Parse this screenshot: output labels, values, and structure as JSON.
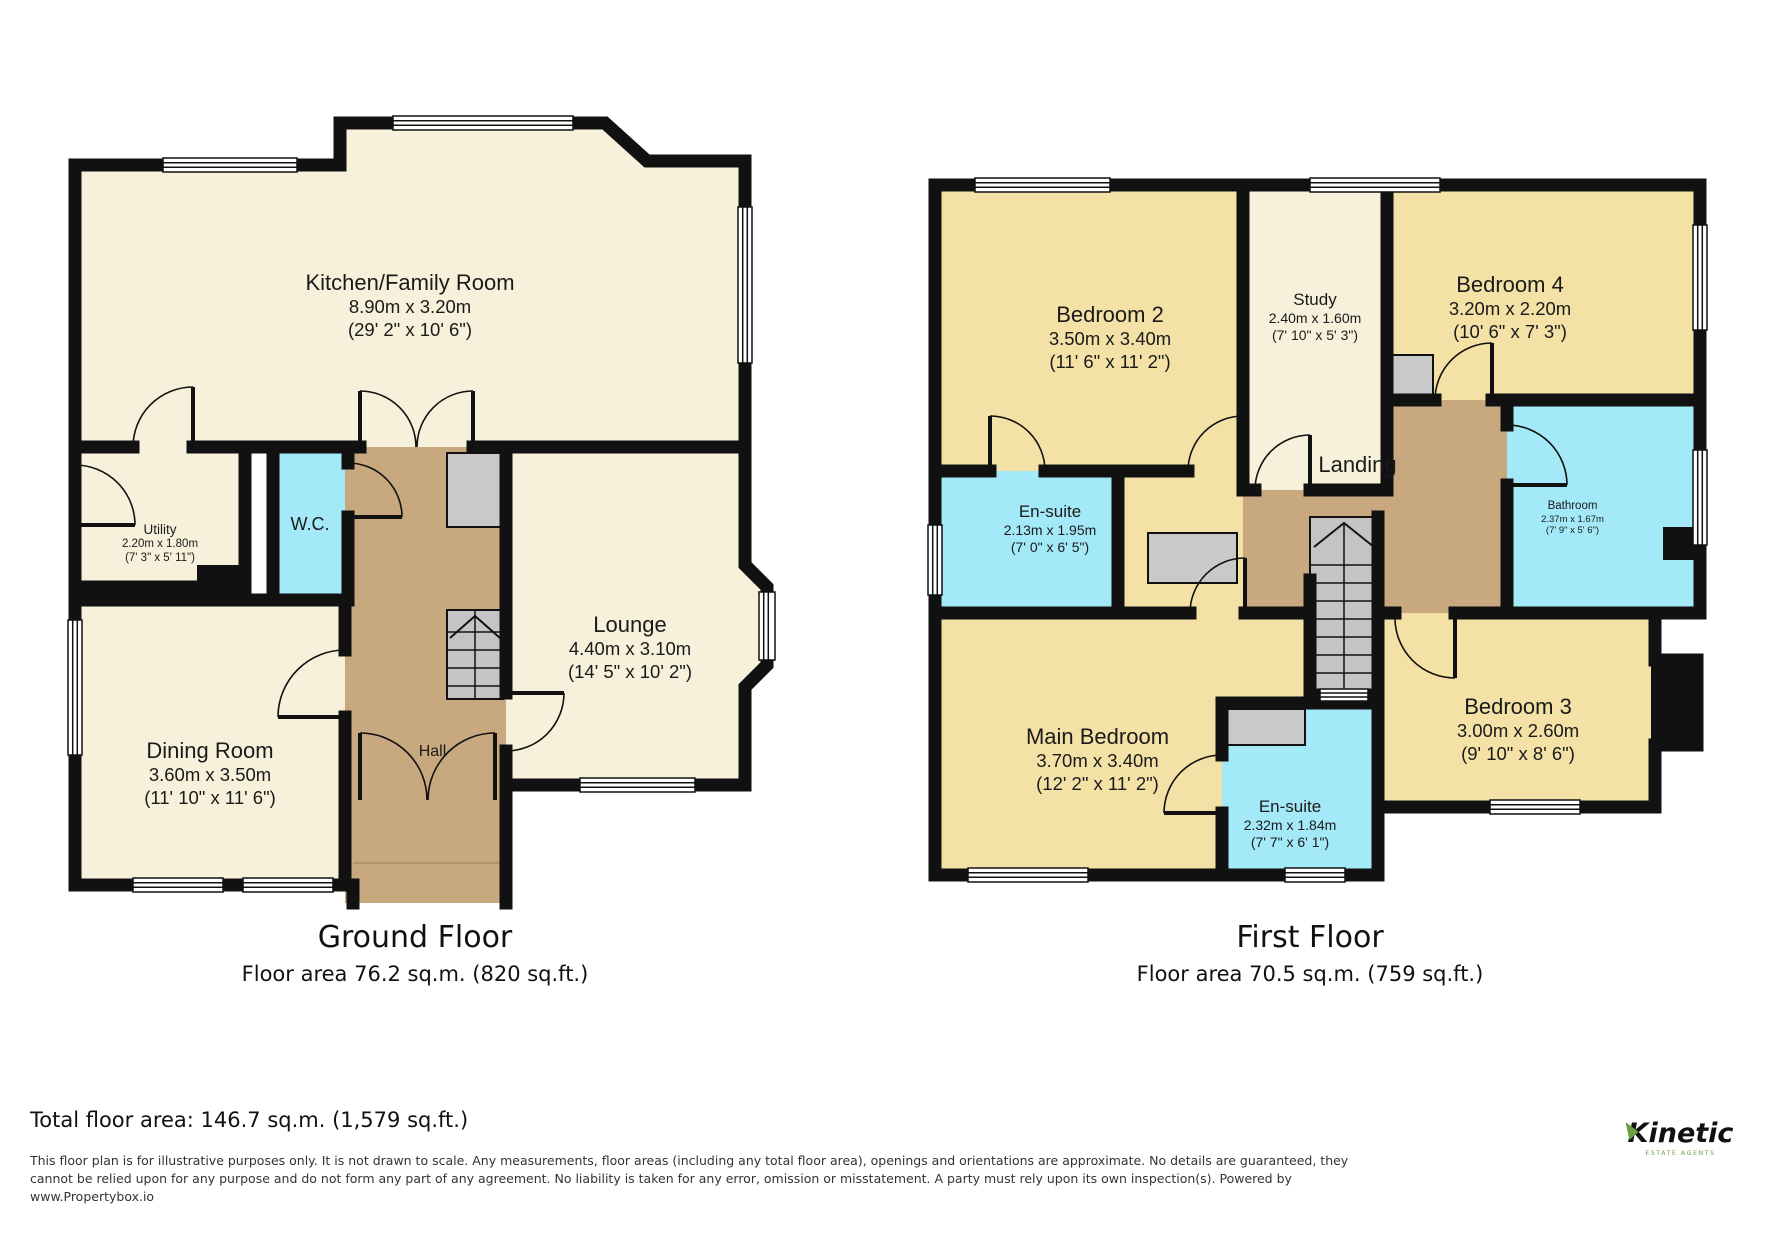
{
  "colors": {
    "room_cream": "#F7F1DB",
    "room_tan": "#F3E1A6",
    "room_cyan": "#A3E9F7",
    "hall_brown": "#C8A87E",
    "stair_gray": "#C4C4C4",
    "wall": "#111111",
    "logo_green": "#69A041"
  },
  "ground_floor": {
    "caption": "Ground Floor",
    "area_caption": "Floor area 76.2 sq.m. (820 sq.ft.)",
    "rooms": [
      {
        "id": "kitchen",
        "name": "Kitchen/Family Room",
        "metric": "8.90m x 3.20m",
        "imperial": "(29' 2\" x 10' 6\")"
      },
      {
        "id": "utility",
        "name": "Utility",
        "metric": "2.20m x 1.80m",
        "imperial": "(7' 3\" x 5' 11\")"
      },
      {
        "id": "wc",
        "name": "W.C."
      },
      {
        "id": "dining",
        "name": "Dining Room",
        "metric": "3.60m x 3.50m",
        "imperial": "(11' 10\" x 11' 6\")"
      },
      {
        "id": "hall",
        "name": "Hall"
      },
      {
        "id": "lounge",
        "name": "Lounge",
        "metric": "4.40m x 3.10m",
        "imperial": "(14' 5\" x 10' 2\")"
      }
    ]
  },
  "first_floor": {
    "caption": "First Floor",
    "area_caption": "Floor area 70.5 sq.m. (759 sq.ft.)",
    "rooms": [
      {
        "id": "bedroom2",
        "name": "Bedroom 2",
        "metric": "3.50m x 3.40m",
        "imperial": "(11' 6\" x 11' 2\")"
      },
      {
        "id": "study",
        "name": "Study",
        "metric": "2.40m x 1.60m",
        "imperial": "(7' 10\" x 5' 3\")"
      },
      {
        "id": "bedroom4",
        "name": "Bedroom 4",
        "metric": "3.20m x 2.20m",
        "imperial": "(10' 6\" x 7' 3\")"
      },
      {
        "id": "ensuite1",
        "name": "En-suite",
        "metric": "2.13m x 1.95m",
        "imperial": "(7' 0\" x 6' 5\")"
      },
      {
        "id": "landing",
        "name": "Landing"
      },
      {
        "id": "bathroom",
        "name": "Bathroom",
        "metric": "2.37m x 1.67m",
        "imperial": "(7' 9\" x 5' 6\")"
      },
      {
        "id": "main_bedroom",
        "name": "Main Bedroom",
        "metric": "3.70m x 3.40m",
        "imperial": "(12' 2\" x 11' 2\")"
      },
      {
        "id": "ensuite2",
        "name": "En-suite",
        "metric": "2.32m x 1.84m",
        "imperial": "(7' 7\" x 6' 1\")"
      },
      {
        "id": "bedroom3",
        "name": "Bedroom 3",
        "metric": "3.00m x 2.60m",
        "imperial": "(9' 10\" x 8' 6\")"
      }
    ]
  },
  "footer": {
    "total": "Total floor area: 146.7 sq.m. (1,579 sq.ft.)",
    "disclaimer_lines": [
      "This floor plan is for illustrative purposes only. It is not drawn to scale. Any measurements, floor areas (including any total floor area), openings and orientations are approximate. No details are guaranteed, they",
      "cannot be relied upon for any purpose and do not form any part of any agreement. No liability is taken for any error, omission or misstatement. A party must rely upon its own inspection(s). Powered by",
      "www.Propertybox.io"
    ],
    "logo": {
      "name": "Kinetic",
      "tagline": "ESTATE AGENTS"
    }
  }
}
